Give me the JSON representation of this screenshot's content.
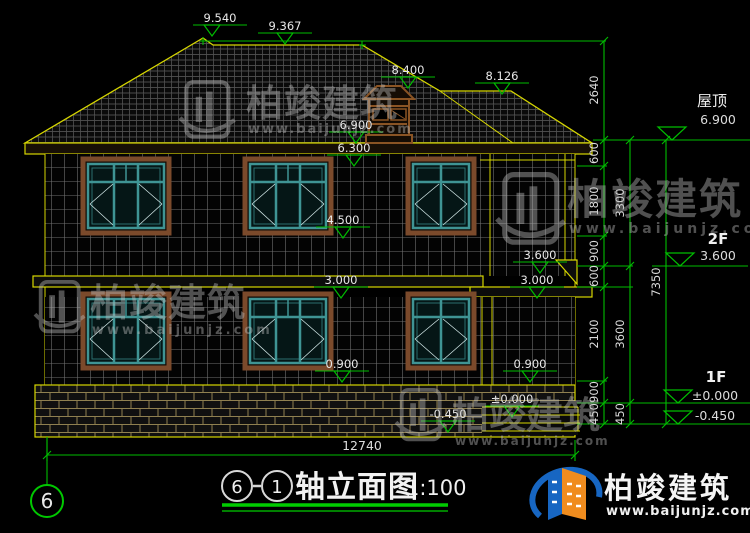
{
  "drawing": {
    "levels": {
      "roof_peak": "9.540",
      "roof_ridge": "9.367",
      "cupola_top": "8.400",
      "ridge_low": "8.126",
      "eave": "6.900",
      "win_top_2f": "6.300",
      "sill_2f": "4.500",
      "porch_roof": "3.600",
      "floor2_left": "3.000",
      "floor2_right": "3.000",
      "sill_1f_left": "0.900",
      "sill_1f_right": "0.900",
      "porch_floor": "±0.000",
      "ground": "-0.450"
    },
    "right_levels": {
      "roof_label": "屋顶",
      "roof_value": "6.900",
      "f2_label": "2F",
      "f2_value": "3.600",
      "f1_label": "1F",
      "f1_value": "±0.000",
      "ground_value": "-0.450"
    },
    "dim_chain_inner": [
      "2640",
      "600",
      "1800",
      "900",
      "600",
      "2100",
      "900",
      "450"
    ],
    "dim_chain_mid": [
      "3300",
      "3600",
      "450"
    ],
    "dim_chain_outer": [
      "7350"
    ],
    "total_width": "12740",
    "axis_bubble": "6"
  },
  "title_block": {
    "axis_start": "6",
    "axis_end": "1",
    "name": "轴立面图",
    "scale": "1:100"
  },
  "watermark": {
    "brand": "柏竣建筑",
    "website": "www.baijunjz.com"
  },
  "logo": {
    "brand": "柏竣建筑",
    "website": "www.baijunjz.com"
  }
}
